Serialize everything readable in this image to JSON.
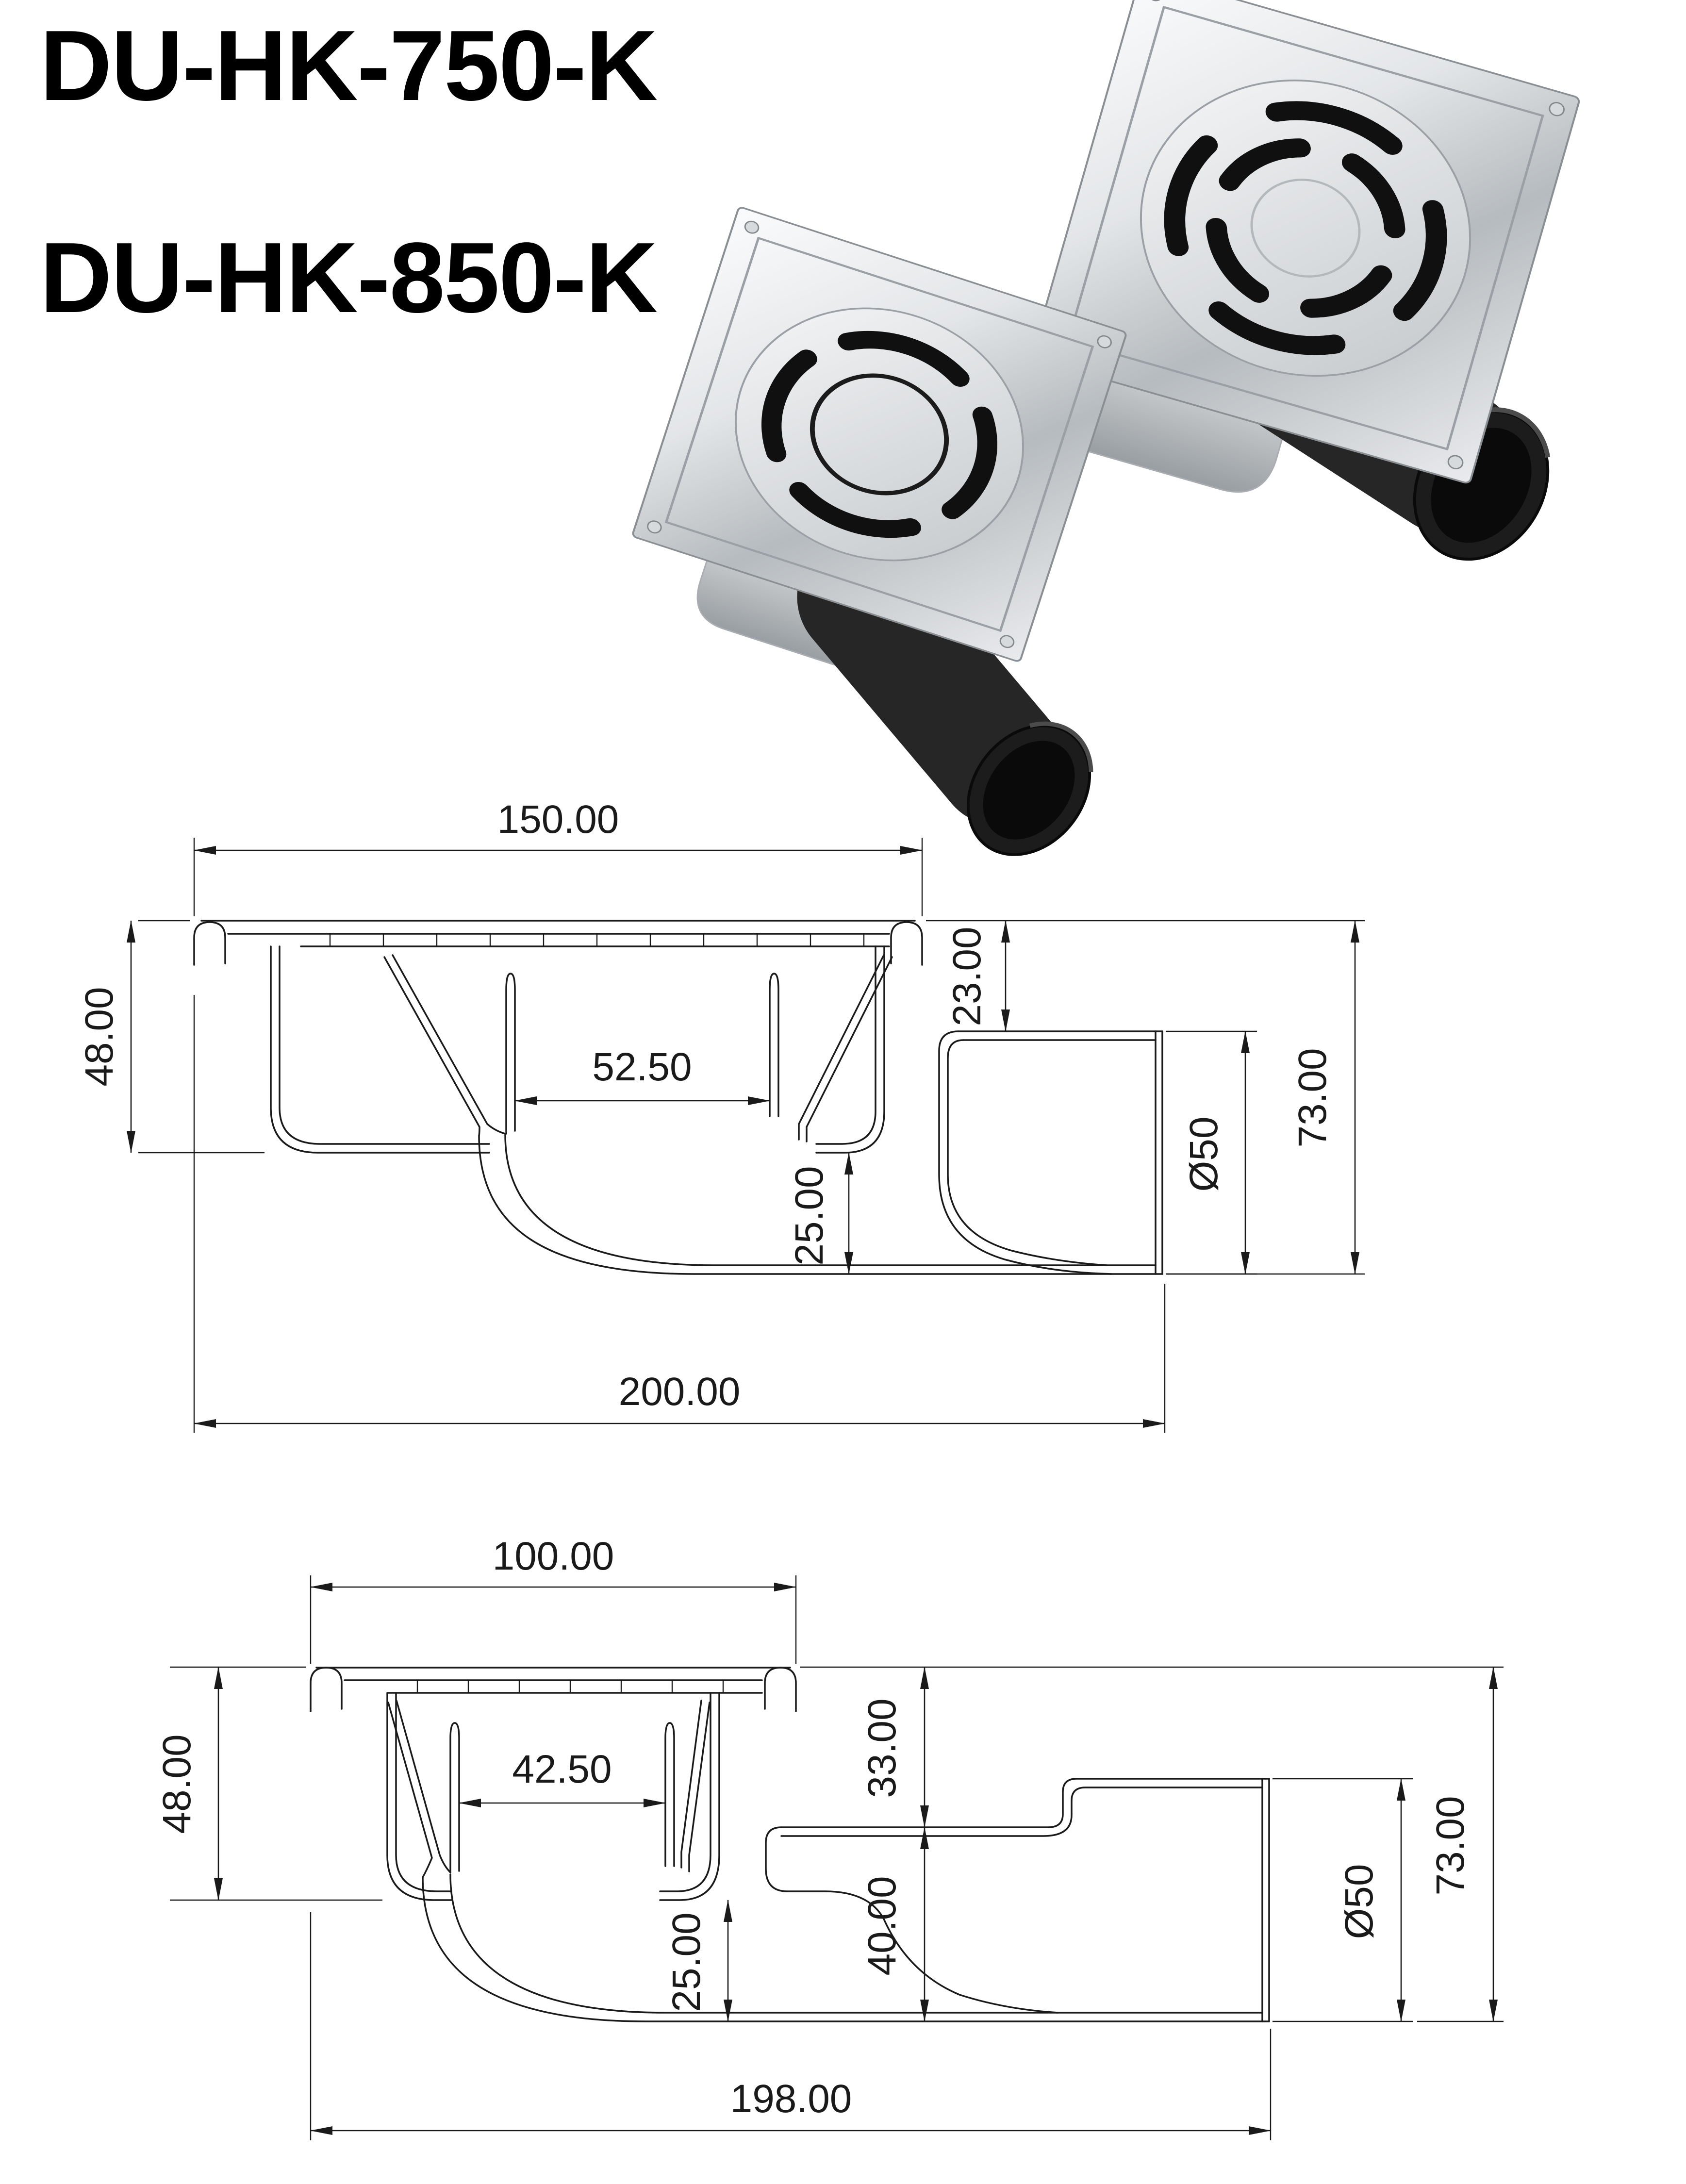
{
  "title": {
    "line1": "DU-HK-750-K",
    "line2": "DU-HK-850-K"
  },
  "colors": {
    "background": "#ffffff",
    "line": "#1a1a1a",
    "metal_light": "#f4f5f6",
    "metal_dark": "#b0b5b9",
    "pipe_black": "#222222"
  },
  "drawing1": {
    "top_width": "150.00",
    "left_height": "48.00",
    "inner_width": "52.50",
    "flange_to_pipe": "23.00",
    "outlet_drop": "25.00",
    "pipe_diameter": "Ø50",
    "total_height": "73.00",
    "total_length": "200.00"
  },
  "drawing2": {
    "top_width": "100.00",
    "left_height": "48.00",
    "inner_width": "42.50",
    "upper_right_height": "33.00",
    "lower_right_height": "40.00",
    "outlet_drop": "25.00",
    "pipe_diameter": "Ø50",
    "total_height": "73.00",
    "total_length": "198.00"
  }
}
